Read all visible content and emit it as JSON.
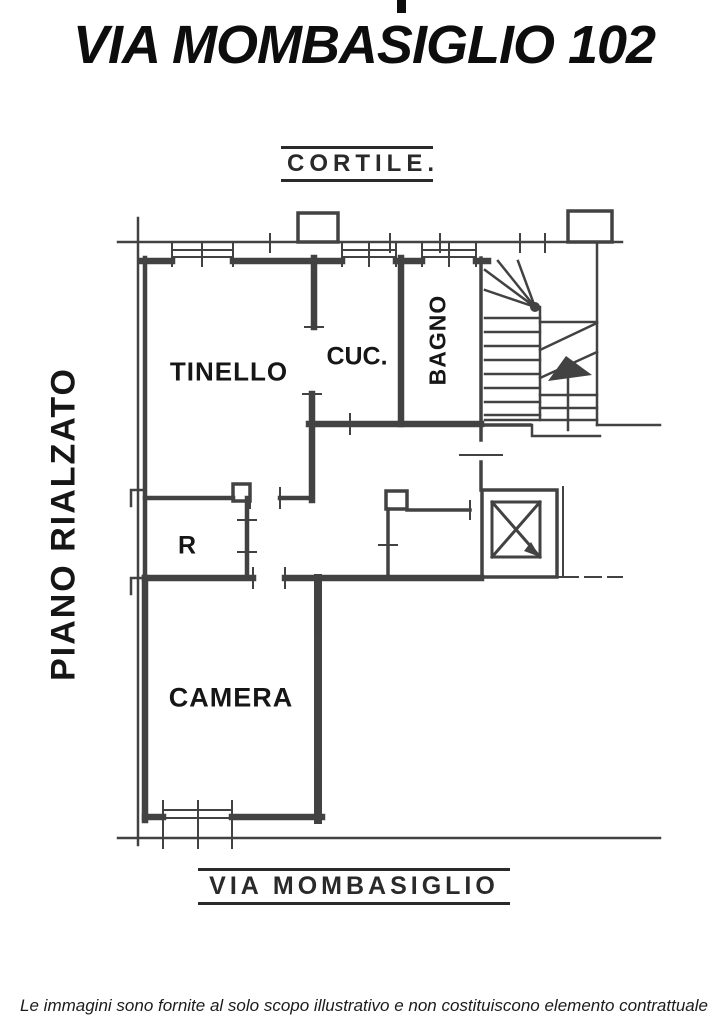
{
  "title": "VIA MOMBASIGLIO 102",
  "floor_label": "PIANO RIALZATO",
  "plan": {
    "top_label": "CORTILE.",
    "bottom_label": "VIA MOMBASIGLIO",
    "rooms": [
      {
        "id": "tinello",
        "label": "TINELLO"
      },
      {
        "id": "cucina",
        "label": "CUC."
      },
      {
        "id": "bagno",
        "label": "BAGNO"
      },
      {
        "id": "ripostiglio",
        "label": "R"
      },
      {
        "id": "camera",
        "label": "CAMERA"
      }
    ],
    "features": [
      "stairs",
      "elevator"
    ]
  },
  "footer": {
    "disclaimer": "Le immagini sono fornite al solo scopo illustrativo e non costituiscono elemento contrattuale"
  },
  "colors": {
    "line": "#333333",
    "text": "#111111",
    "background": "#ffffff"
  }
}
